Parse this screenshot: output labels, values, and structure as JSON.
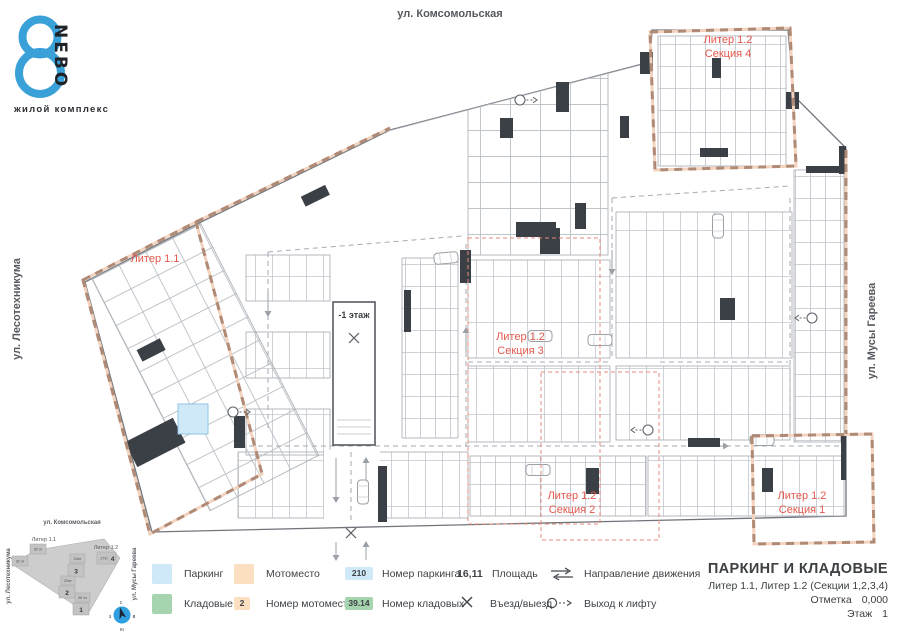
{
  "logo": {
    "number": "8",
    "name": "NEBO",
    "subtitle": "жилой комплекс"
  },
  "streets": {
    "top": "ул. Комсомольская",
    "left": "ул. Лесотехникума",
    "right": "ул. Мусы Гареева"
  },
  "plan_labels": {
    "liter_1_1": "Литер 1.1",
    "section_4": [
      "Литер 1.2",
      "Секция 4"
    ],
    "section_3": [
      "Литер 1.2",
      "Секция 3"
    ],
    "section_2": [
      "Литер 1.2",
      "Секция 2"
    ],
    "section_1": [
      "Литер 1.2",
      "Секция 1"
    ],
    "ramp": "-1 этаж"
  },
  "minimap": {
    "streets": {
      "top": "ул. Комсомольская",
      "left": "ул. Лесотехникума",
      "right": "ул. Мусы Гареева"
    },
    "liter_1_1": "Литер 1.1",
    "liter_1_2": "Литер 1.2",
    "cells": {
      "c30": "30 эт",
      "c32": "32 эт",
      "f3": "24эт",
      "n3": "3",
      "f4": "17эт",
      "n4": "4",
      "f2": "20эт",
      "n2": "2",
      "f1": "20 эт",
      "n1": "1"
    },
    "compass": {
      "n": "с",
      "e": "в",
      "s": "ю",
      "w": "з"
    }
  },
  "legend": {
    "row1": [
      {
        "type": "swatch",
        "swatch": "parking",
        "label": "Паркинг"
      },
      {
        "type": "swatch",
        "swatch": "moto",
        "label": "Мотоместо"
      },
      {
        "type": "badge",
        "swatch": "parking",
        "value": "210",
        "label": "Номер паркинга"
      },
      {
        "type": "value",
        "value": "16,11",
        "label": "Площадь"
      },
      {
        "type": "icon",
        "icon": "direction-arrows",
        "label": "Направление движения"
      }
    ],
    "row2": [
      {
        "type": "swatch",
        "swatch": "storage",
        "label": "Кладовые"
      },
      {
        "type": "badge",
        "swatch": "moto",
        "value": "2",
        "label": "Номер мотоместа"
      },
      {
        "type": "badge",
        "swatch": "storage",
        "value": "39.14",
        "label": "Номер кладовых"
      },
      {
        "type": "icon",
        "icon": "entry-x",
        "label": "Въезд/выезд"
      },
      {
        "type": "icon",
        "icon": "lift-exit",
        "label": "Выход к лифту"
      }
    ]
  },
  "titleblock": {
    "title": "ПАРКИНГ И КЛАДОВЫЕ",
    "subtitle": "Литер 1.1, Литер 1.2 (Секции 1,2,3,4)",
    "mark_label": "Отметка",
    "mark_value": "0,000",
    "floor_label": "Этаж",
    "floor_value": "1"
  },
  "colors": {
    "parking": "#cfe9f8",
    "moto_place": "#fbdfc0",
    "storage": "#a6d4ae",
    "accent_red": "#e4574c",
    "section_boundary_peach": "#d9a98f",
    "logo_blue": "#3aa0d8",
    "compass_blue": "#2f9fe0",
    "walls_dark": "#3a4046"
  }
}
